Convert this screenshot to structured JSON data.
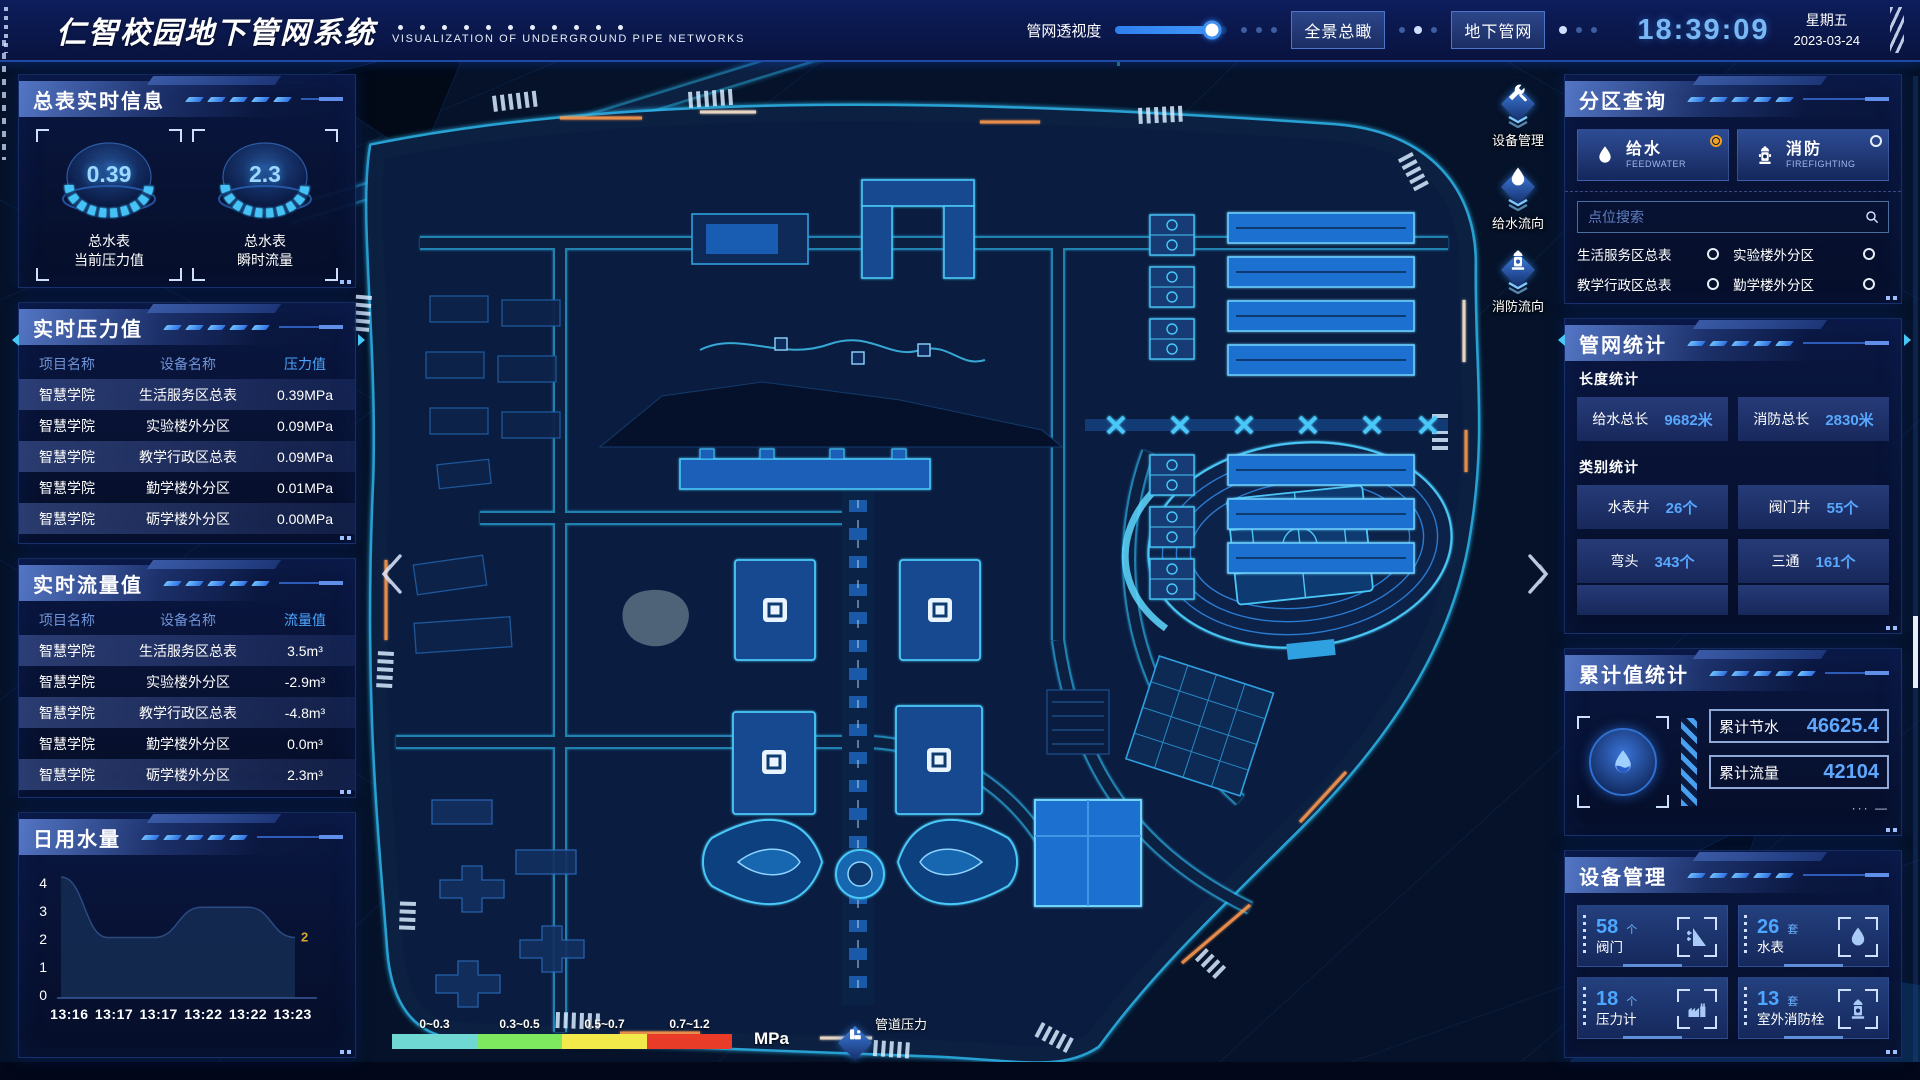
{
  "header": {
    "title": "仁智校园地下管网系统",
    "subtitle": "VISUALIZATION OF UNDERGROUND PIPE NETWORKS",
    "perspective_label": "管网透视度",
    "perspective_value_pct": 86,
    "btn_overview": "全景总瞰",
    "btn_underground": "地下管网",
    "time": "18:39:09",
    "weekday": "星期五",
    "date": "2023-03-24"
  },
  "left": {
    "meters": {
      "title": "总表实时信息",
      "gauges": [
        {
          "value": "0.39",
          "line1": "总水表",
          "line2": "当前压力值"
        },
        {
          "value": "2.3",
          "line1": "总水表",
          "line2": "瞬时流量"
        }
      ]
    },
    "pressure": {
      "title": "实时压力值",
      "col_project": "项目名称",
      "col_device": "设备名称",
      "col_value": "压力值",
      "rows": [
        {
          "project": "智慧学院",
          "device": "生活服务区总表",
          "value": "0.39MPa"
        },
        {
          "project": "智慧学院",
          "device": "实验楼外分区",
          "value": "0.09MPa"
        },
        {
          "project": "智慧学院",
          "device": "教学行政区总表",
          "value": "0.09MPa"
        },
        {
          "project": "智慧学院",
          "device": "勤学楼外分区",
          "value": "0.01MPa"
        },
        {
          "project": "智慧学院",
          "device": "砺学楼外分区",
          "value": "0.00MPa"
        }
      ]
    },
    "flow": {
      "title": "实时流量值",
      "col_project": "项目名称",
      "col_device": "设备名称",
      "col_value": "流量值",
      "rows": [
        {
          "project": "智慧学院",
          "device": "生活服务区总表",
          "value": "3.5m³"
        },
        {
          "project": "智慧学院",
          "device": "实验楼外分区",
          "value": "-2.9m³"
        },
        {
          "project": "智慧学院",
          "device": "教学行政区总表",
          "value": "-4.8m³"
        },
        {
          "project": "智慧学院",
          "device": "勤学楼外分区",
          "value": "0.0m³"
        },
        {
          "project": "智慧学院",
          "device": "砺学楼外分区",
          "value": "2.3m³"
        }
      ]
    },
    "daily": {
      "title": "日用水量"
    }
  },
  "chart_data": {
    "type": "area",
    "title": "日用水量",
    "x": [
      "13:16",
      "13:17",
      "13:17",
      "13:22",
      "13:22",
      "13:23"
    ],
    "values": [
      4,
      2,
      2,
      3,
      3,
      2
    ],
    "ylim": [
      0,
      4
    ],
    "yticks": [
      "4",
      "3",
      "2",
      "1",
      "0"
    ],
    "xlabel": "",
    "ylabel": "",
    "grid": false,
    "legend_position": "none",
    "last_point_label": "2",
    "area_color": "#152a50",
    "label_color": "#d9a62e"
  },
  "map": {
    "toolbar": [
      {
        "label": "设备管理",
        "icon": "tools-icon"
      },
      {
        "label": "给水流向",
        "icon": "water-drop-icon"
      },
      {
        "label": "消防流向",
        "icon": "hydrant-icon"
      }
    ],
    "legend": {
      "ranges": [
        {
          "label": "0~0.3",
          "color": "#6fd8d2"
        },
        {
          "label": "0.3~0.5",
          "color": "#7ee85e"
        },
        {
          "label": "0.5~0.7",
          "color": "#f2ea4a"
        },
        {
          "label": "0.7~1.2",
          "color": "#e83c28"
        }
      ],
      "unit": "MPa",
      "pressure_label": "管道压力"
    }
  },
  "right": {
    "zone": {
      "title": "分区查询",
      "modes": [
        {
          "label": "给水",
          "sub": "FEEDWATER",
          "selected": true
        },
        {
          "label": "消防",
          "sub": "FIREFIGHTING",
          "selected": false
        }
      ],
      "search_placeholder": "点位搜索",
      "zones": [
        "生活服务区总表",
        "实验楼外分区",
        "教学行政区总表",
        "勤学楼外分区",
        "砺学楼外分区",
        "宿舍区泵房"
      ]
    },
    "network": {
      "title": "管网统计",
      "length_title": "长度统计",
      "length_stats": [
        {
          "label": "给水总长",
          "value": "9682米"
        },
        {
          "label": "消防总长",
          "value": "2830米"
        }
      ],
      "category_title": "类别统计",
      "category_stats": [
        {
          "label": "水表井",
          "value": "26个"
        },
        {
          "label": "阀门井",
          "value": "55个"
        },
        {
          "label": "弯头",
          "value": "343个"
        },
        {
          "label": "三通",
          "value": "161个"
        }
      ]
    },
    "cumulative": {
      "title": "累计值统计",
      "stats": [
        {
          "label": "累计节水",
          "value": "46625.4"
        },
        {
          "label": "累计流量",
          "value": "42104"
        }
      ]
    },
    "devices": {
      "title": "设备管理",
      "cards": [
        {
          "count": "58",
          "unit": "个",
          "label": "阀门",
          "icon": "valve-icon"
        },
        {
          "count": "26",
          "unit": "套",
          "label": "水表",
          "icon": "water-meter-icon"
        },
        {
          "count": "18",
          "unit": "个",
          "label": "压力计",
          "icon": "pressure-gauge-icon"
        },
        {
          "count": "13",
          "unit": "套",
          "label": "室外消防栓",
          "icon": "outdoor-hydrant-icon"
        }
      ]
    }
  }
}
